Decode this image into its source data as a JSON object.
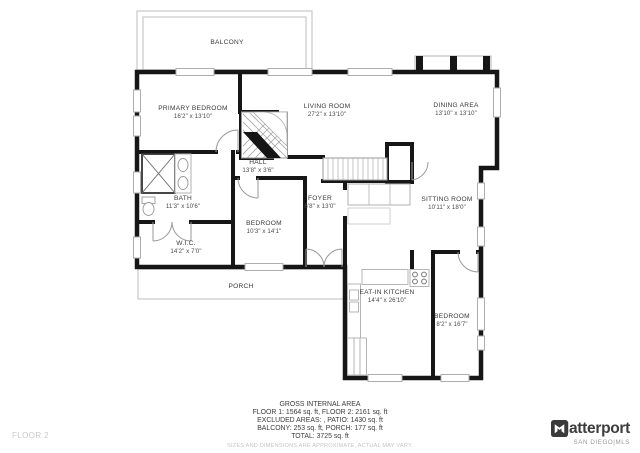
{
  "floor_label": "FLOOR 2",
  "brand": {
    "name": "Matterport",
    "sub": "SAN DIEGO|MLS"
  },
  "summary": {
    "title": "GROSS INTERNAL AREA",
    "line1": "FLOOR 1: 1564 sq. ft, FLOOR 2: 2161 sq. ft",
    "line2": "EXCLUDED AREAS: , PATIO: 1430 sq. ft",
    "line3": "BALCONY: 253 sq. ft, PORCH: 177 sq. ft",
    "line4": "TOTAL: 3725 sq. ft",
    "disclaimer": "SIZES AND DIMENSIONS ARE APPROXIMATE, ACTUAL MAY VARY."
  },
  "rooms": [
    {
      "name": "BALCONY",
      "dims": ""
    },
    {
      "name": "PRIMARY BEDROOM",
      "dims": "16'2\" x 13'10\""
    },
    {
      "name": "LIVING ROOM",
      "dims": "27'2\" x 13'10\""
    },
    {
      "name": "DINING AREA",
      "dims": "13'10\" x 13'10\""
    },
    {
      "name": "HALL",
      "dims": "13'8\" x 3'6\""
    },
    {
      "name": "BATH",
      "dims": "11'3\" x 10'6\""
    },
    {
      "name": "W.I.C.",
      "dims": "14'2\" x 7'0\""
    },
    {
      "name": "BEDROOM",
      "dims": "10'3\" x 14'1\""
    },
    {
      "name": "FOYER",
      "dims": "6'8\" x 13'0\""
    },
    {
      "name": "SITTING ROOM",
      "dims": "10'11\" x 18'0\""
    },
    {
      "name": "PORCH",
      "dims": ""
    },
    {
      "name": "EAT-IN KITCHEN",
      "dims": "14'4\" x 26'10\""
    },
    {
      "name": "BEDROOM",
      "dims": "8'2\" x 16'7\""
    }
  ]
}
